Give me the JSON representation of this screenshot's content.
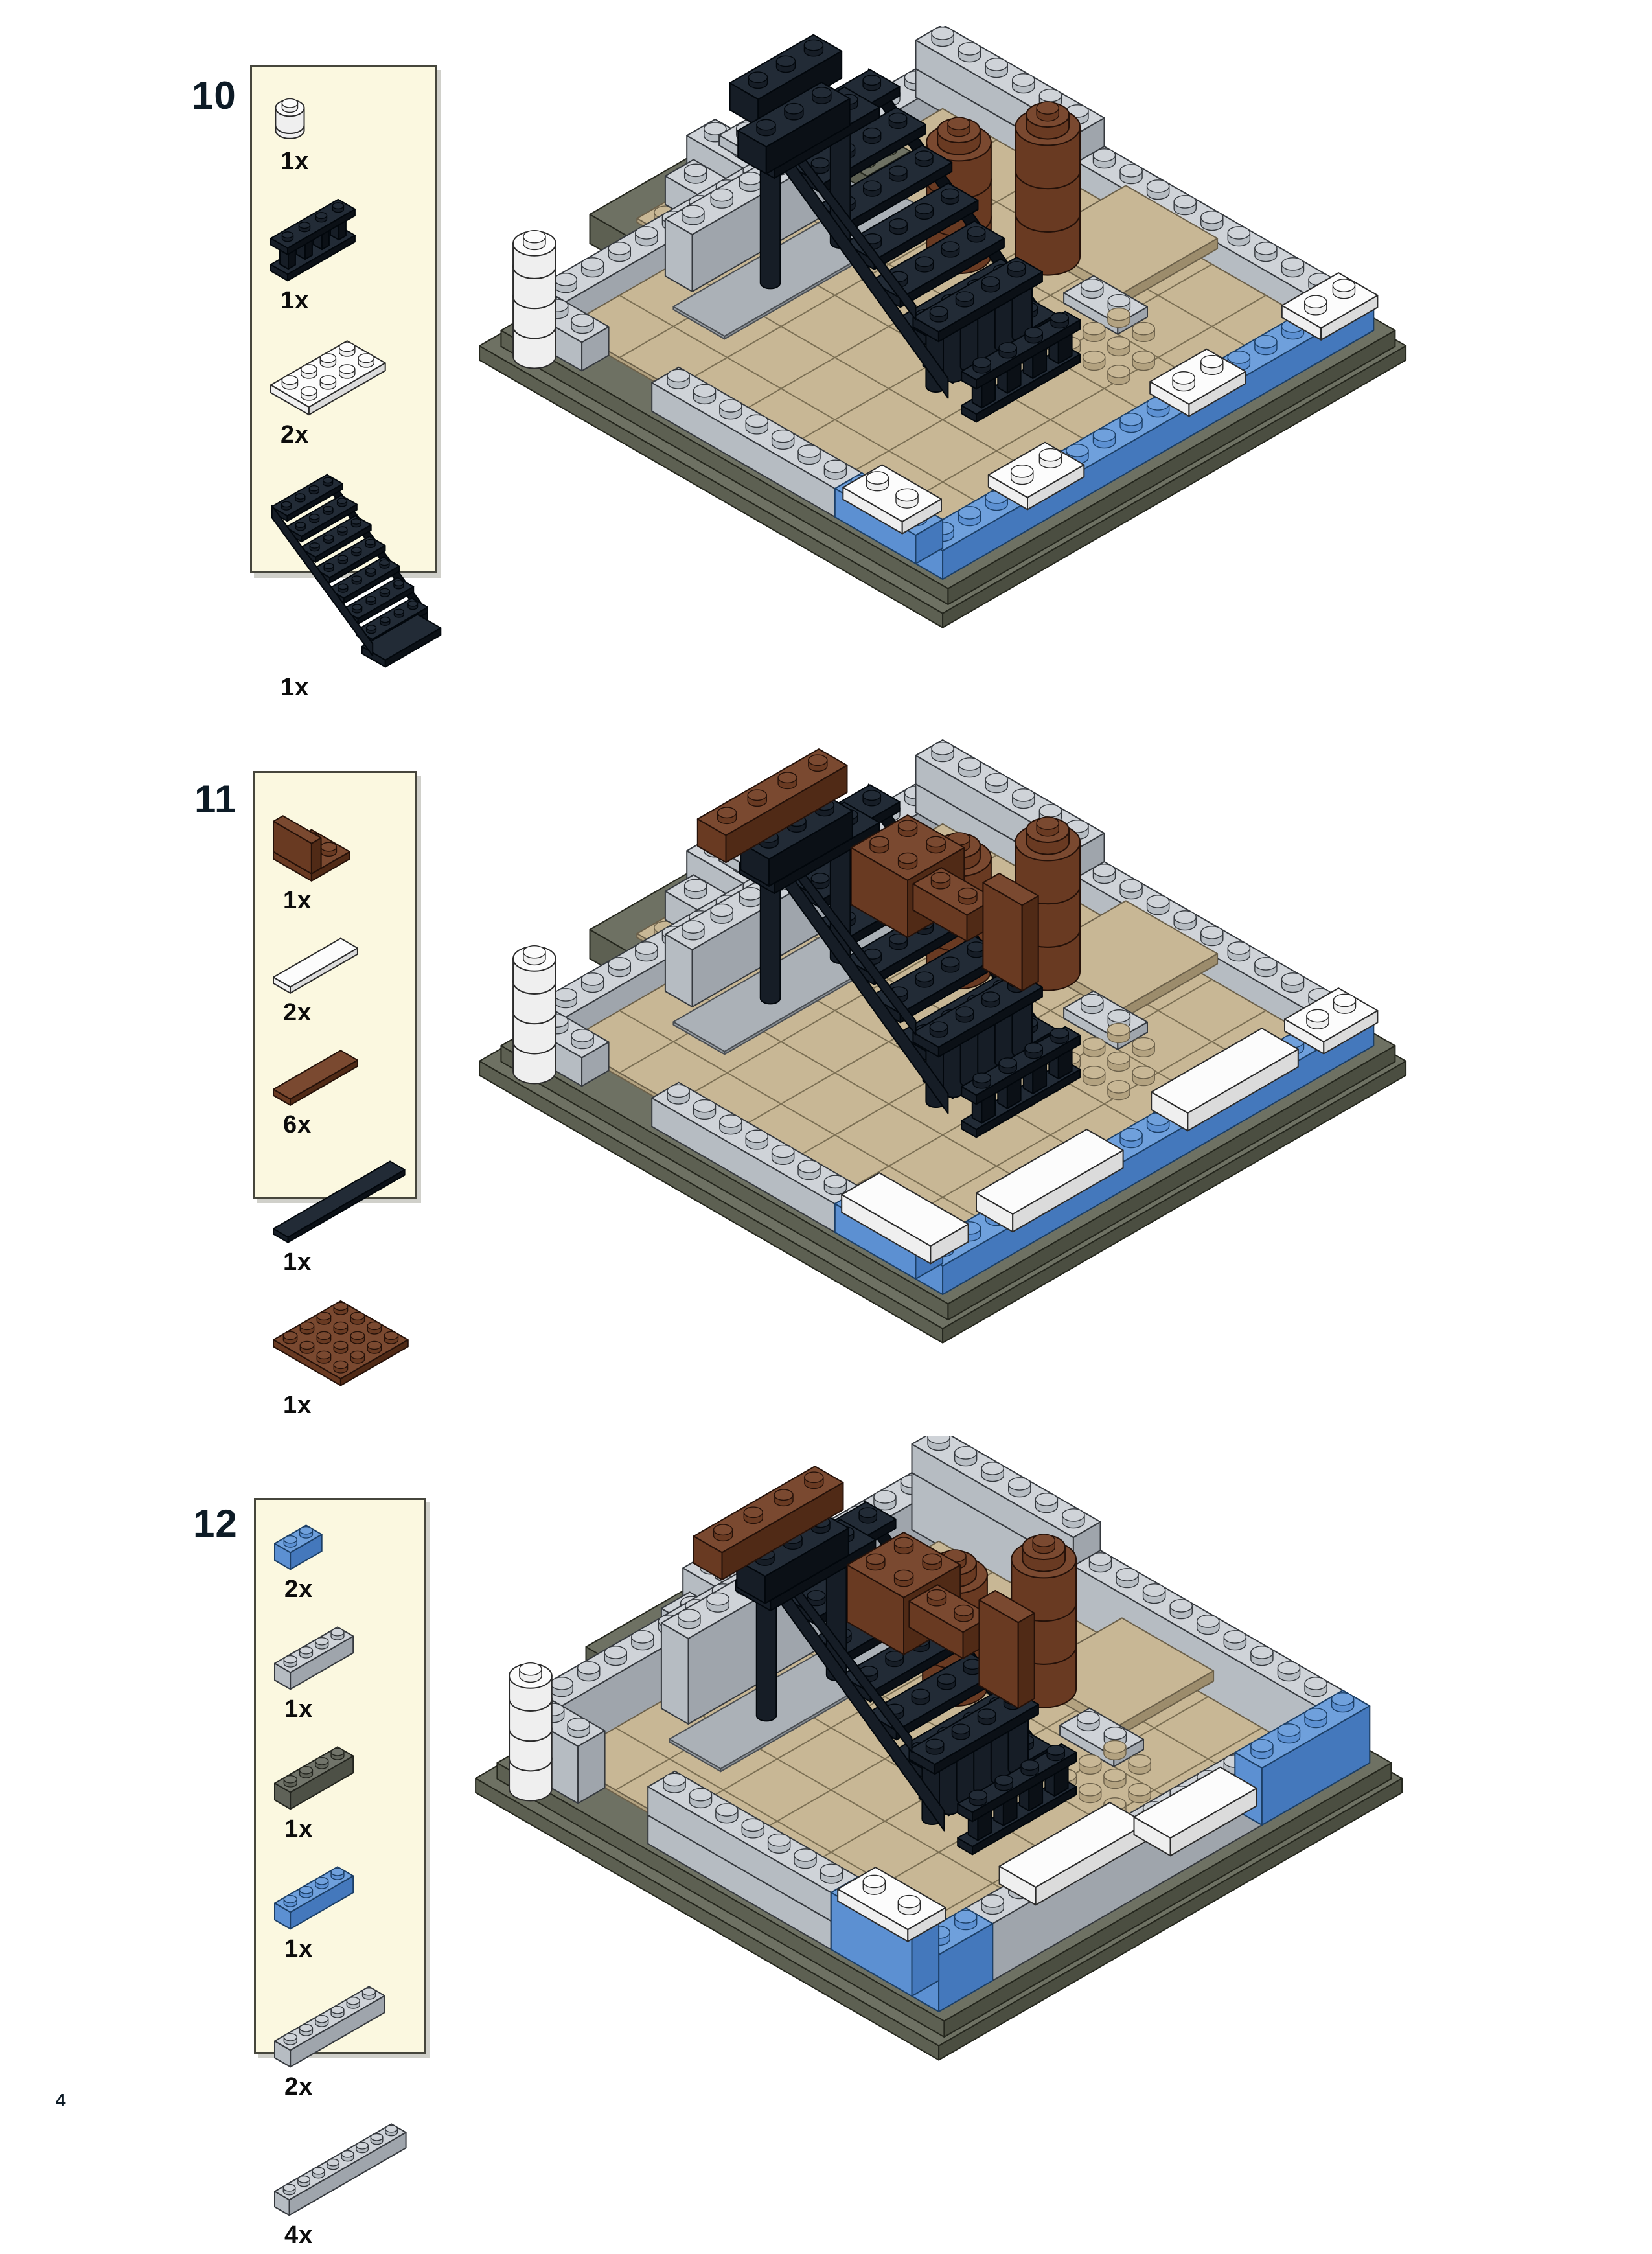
{
  "page": {
    "number": "4",
    "background": "#FFFFFF"
  },
  "parts_box": {
    "background": "#FBF8E0",
    "border": "#46463C"
  },
  "steps": [
    {
      "number": "10",
      "parts": [
        {
          "qty": "1x",
          "label": "1x1 round brick, white",
          "shape": "round",
          "size": [
            1,
            1
          ],
          "color": "white"
        },
        {
          "qty": "1x",
          "label": "1x4x2 fence with posts, black",
          "shape": "fence",
          "size": [
            1,
            4
          ],
          "color": "black"
        },
        {
          "qty": "2x",
          "label": "2x4 plate, white",
          "shape": "plate",
          "size": [
            2,
            4
          ],
          "color": "white"
        },
        {
          "qty": "1x",
          "label": "7x4x6 staircase, black",
          "shape": "stairs",
          "size": [
            4,
            7
          ],
          "color": "black"
        }
      ]
    },
    {
      "number": "11",
      "parts": [
        {
          "qty": "1x",
          "label": "2x2x2 corner panel, reddish brown",
          "shape": "panel",
          "size": [
            2,
            2
          ],
          "color": "brown"
        },
        {
          "qty": "2x",
          "label": "1x4 tile, white",
          "shape": "tile",
          "size": [
            1,
            4
          ],
          "color": "white"
        },
        {
          "qty": "6x",
          "label": "1x4 tile, reddish brown",
          "shape": "tile",
          "size": [
            1,
            4
          ],
          "color": "brown"
        },
        {
          "qty": "1x",
          "label": "1x8 tile, black",
          "shape": "tile",
          "size": [
            1,
            8
          ],
          "color": "black"
        },
        {
          "qty": "1x",
          "label": "4x4 plate, reddish brown",
          "shape": "plate",
          "size": [
            4,
            4
          ],
          "color": "brown"
        }
      ]
    },
    {
      "number": "12",
      "parts": [
        {
          "qty": "2x",
          "label": "1x2 brick, blue",
          "shape": "brick",
          "size": [
            1,
            2
          ],
          "color": "blue"
        },
        {
          "qty": "1x",
          "label": "1x4 brick, light gray",
          "shape": "brick",
          "size": [
            1,
            4
          ],
          "color": "gray"
        },
        {
          "qty": "1x",
          "label": "1x4 brick, dark gray",
          "shape": "brick",
          "size": [
            1,
            4
          ],
          "color": "darkgray"
        },
        {
          "qty": "1x",
          "label": "1x4 brick, blue",
          "shape": "brick",
          "size": [
            1,
            4
          ],
          "color": "blue"
        },
        {
          "qty": "2x",
          "label": "1x6 brick, light gray",
          "shape": "brick",
          "size": [
            1,
            6
          ],
          "color": "gray"
        },
        {
          "qty": "4x",
          "label": "1x8 brick, light gray",
          "shape": "brick",
          "size": [
            1,
            8
          ],
          "color": "gray"
        }
      ]
    }
  ],
  "palette": {
    "white": {
      "top": "#FCFCFC",
      "left": "#EFEFEF",
      "right": "#DBDBDB",
      "line": "#2B2B2B"
    },
    "black": {
      "top": "#222B36",
      "left": "#161D26",
      "right": "#0B1016",
      "line": "#02070C"
    },
    "brown": {
      "top": "#7A4930",
      "left": "#693A22",
      "right": "#502A16",
      "line": "#241109"
    },
    "blue": {
      "top": "#6FA0DC",
      "left": "#5C90D2",
      "right": "#4478BC",
      "line": "#1C3F66"
    },
    "gray": {
      "top": "#CFD3D8",
      "left": "#B6BCC2",
      "right": "#9FA5AC",
      "line": "#35393E"
    },
    "darkgray": {
      "top": "#71746A",
      "left": "#5F6258",
      "right": "#4D5046",
      "line": "#22241E"
    },
    "base": {
      "top": "#6E7163",
      "left": "#5D6052",
      "right": "#4B4E41",
      "line": "#24261D"
    },
    "grayfloor": {
      "top": "#ABB1B7",
      "left": "#989EA4",
      "right": "#888E94",
      "line": "#4A4E52"
    },
    "tan": {
      "top": "#C8B795",
      "left": "#B3A280",
      "right": "#9C8C6C",
      "line": "#6B604A"
    }
  }
}
